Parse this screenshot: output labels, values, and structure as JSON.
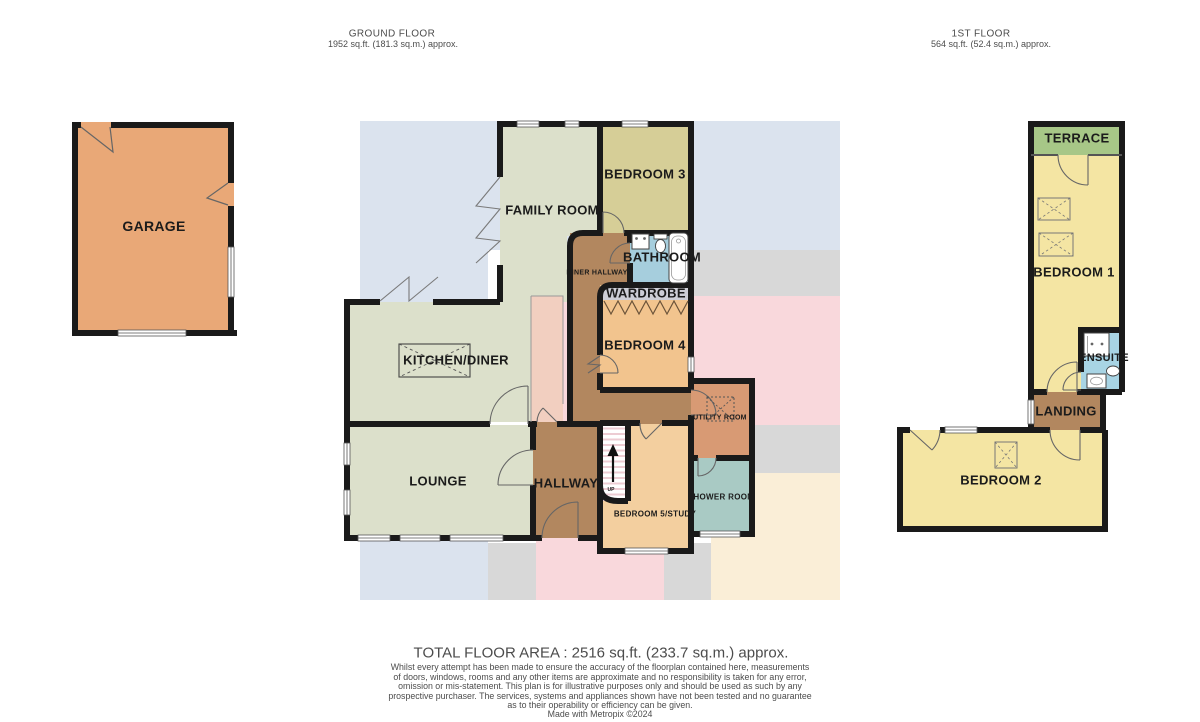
{
  "headers": {
    "ground": {
      "title": "GROUND FLOOR",
      "area": "1952 sq.ft. (181.3 sq.m.) approx."
    },
    "first": {
      "title": "1ST FLOOR",
      "area": "564 sq.ft. (52.4 sq.m.) approx."
    }
  },
  "ground_floor": {
    "garage": "GARAGE",
    "family_room": "FAMILY ROOM",
    "bedroom3": "BEDROOM 3",
    "bathroom": "BATHROOM",
    "inner_hallway": "INNER HALLWAY",
    "wardrobe": "WARDROBE",
    "bedroom4": "BEDROOM 4",
    "kitchen_diner": "KITCHEN/DINER",
    "lounge": "LOUNGE",
    "hallway": "HALLWAY",
    "utility_room": "UTILITY ROOM",
    "shower_room": "SHOWER ROOM",
    "bedroom5": "BEDROOM 5/STUDY",
    "stairs_up": "UP"
  },
  "first_floor": {
    "terrace": "TERRACE",
    "bedroom1": "BEDROOM 1",
    "ensuite": "ENSUITE",
    "landing": "LANDING",
    "bedroom2": "BEDROOM 2"
  },
  "footer": {
    "total_area": "TOTAL FLOOR AREA : 2516 sq.ft. (233.7 sq.m.) approx.",
    "disclaimer_lines": [
      "Whilst every attempt has been made to ensure the accuracy of the floorplan contained here, measurements",
      "of doors, windows, rooms and any other items are approximate and no responsibility is taken for any error,",
      "omission or mis-statement. This plan is for illustrative purposes only and should be used as such by any",
      "prospective purchaser. The services, systems and appliances shown have not been tested and no guarantee",
      "as to their operability or efficiency can be given."
    ],
    "credit": "Made with Metropix ©2024"
  },
  "colors": {
    "wall": "#1a1a1a",
    "garage": "#e9a877",
    "sage": "#dce0cb",
    "khaki_bedroom3": "#d6ce97",
    "bathroom_blue": "#a6cedd",
    "wardrobe_grey": "#cdced6",
    "orange_bedroom4": "#f2c48e",
    "light_orange_bedroom5": "#f3cf9f",
    "utility_salmon": "#d89a74",
    "hall_brown": "#b2875f",
    "shower_teal": "#a9cac4",
    "terrace_green": "#a7c787",
    "bedroom_yellow": "#f4e5a3",
    "ensuite_blue": "#a8d4e4",
    "cupboard_salmon": "#f2cfc0",
    "zone_blue": "#dbe3ee",
    "zone_grey": "#d8d8d8",
    "zone_pink": "#f9d8dc",
    "zone_cream": "#faeed7",
    "stair_stripe": "#edccd3"
  }
}
